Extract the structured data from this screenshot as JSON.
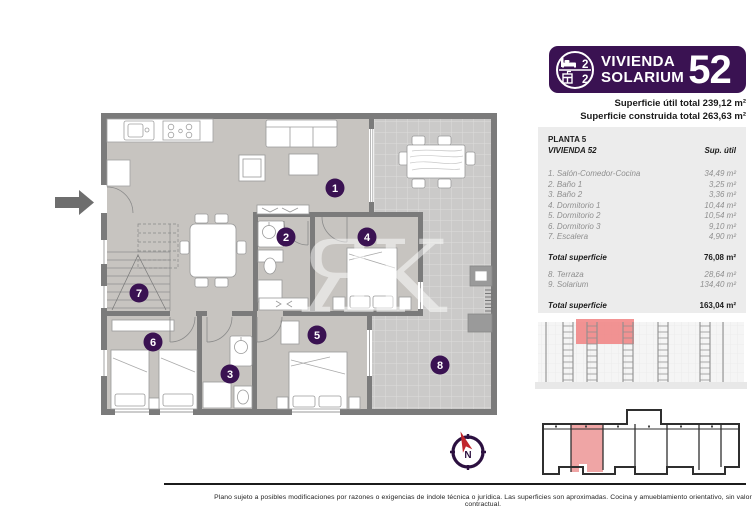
{
  "header": {
    "title_line1": "VIVIENDA",
    "title_line2": "SOLARIUM",
    "unit_number": "52",
    "bedrooms": "2",
    "bathrooms": "2",
    "superficie_util": "Superficie útil total 239,12 m²",
    "superficie_construida": "Superficie construida total 263,63 m²"
  },
  "table": {
    "planta": "PLANTA 5",
    "vivienda": "VIVIENDA 52",
    "col_header": "Sup. útil",
    "rows": [
      {
        "label": "1. Salón-Comedor-Cocina",
        "value": "34,49 m²"
      },
      {
        "label": "2. Baño 1",
        "value": "3,25 m²"
      },
      {
        "label": "3. Baño 2",
        "value": "3,36 m²"
      },
      {
        "label": "4. Dormitorio 1",
        "value": "10,44 m²"
      },
      {
        "label": "5. Dormitorio 2",
        "value": "10,54 m²"
      },
      {
        "label": "6. Dormitorio 3",
        "value": "9,10 m²"
      },
      {
        "label": "7. Escalera",
        "value": "4,90 m²"
      }
    ],
    "subtotal_label": "Total superficie",
    "subtotal_value": "76,08 m²",
    "extra_rows": [
      {
        "label": "8. Terraza",
        "value": "28,64 m²"
      },
      {
        "label": "9. Solarium",
        "value": "134,40 m²"
      }
    ],
    "total_label": "Total superficie",
    "total_value": "163,04 m²"
  },
  "plan": {
    "room_labels": [
      "1",
      "2",
      "3",
      "4",
      "5",
      "6",
      "7",
      "8"
    ],
    "compass_label": "N",
    "watermark": "ЯK"
  },
  "footer": {
    "disclaimer": "Plano sujeto a posibles modificaciones por razones o exigencias de índole técnica o jurídica. Las superficies son aproximadas. Cocina y amueblamiento orientativo, sin valor contractual."
  },
  "colors": {
    "purple": "#3A1252",
    "wall_gray": "#7B7B7B",
    "floor_gray": "#C7C4C0",
    "terrace_gray": "#CBCAC9",
    "highlight_red": "#F07D7D"
  }
}
